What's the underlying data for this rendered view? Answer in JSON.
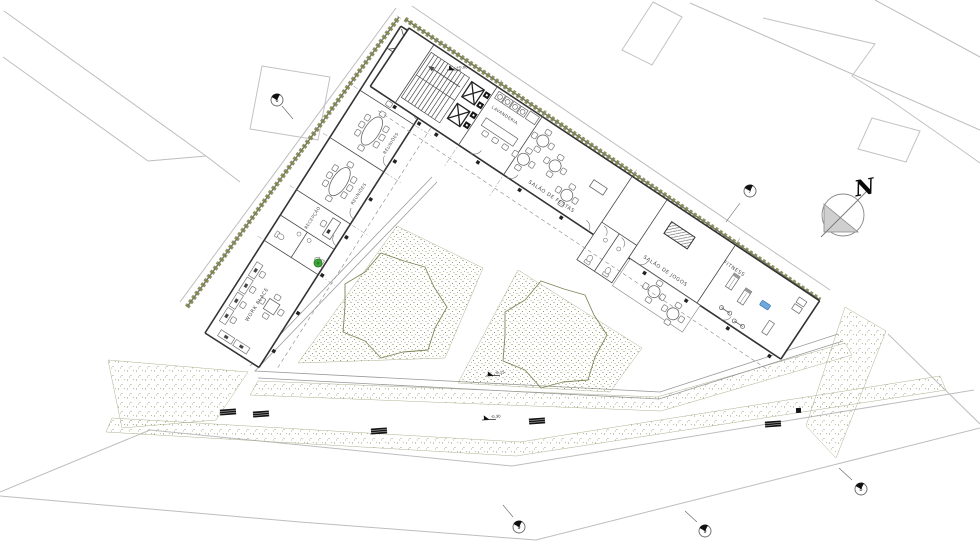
{
  "labels": {
    "north": "N",
    "work_place": "WORK PLACE",
    "reception": "RECEPÇÃO",
    "meeting_a": "REUNIÕES",
    "meeting_b": "REUNIÕES",
    "meeting_c": "REUNIÕES",
    "laundry": "LAVANDERIA",
    "party_room": "SALÃO DE FESTAS",
    "game_room": "SALÃO DE JOGOS",
    "fitness": "FITNESS"
  },
  "levels": {
    "entry": "+0.00",
    "walk_upper": "-0.15",
    "walk_lower": "-0.30"
  },
  "keynotes": {
    "k1": "6",
    "k2": "7",
    "k3": "8",
    "k4": "9",
    "k5": "9"
  },
  "colors": {
    "hedge_green": "#7d8247",
    "plan_line": "#444444",
    "street_line": "#bdbdbd",
    "stipple": "#9a9a72",
    "tree_outline": "#7e8657",
    "plant_green": "#3fa93a",
    "equipment_blue": "#6fa8dc",
    "north_fill": "#cfcfcf"
  }
}
